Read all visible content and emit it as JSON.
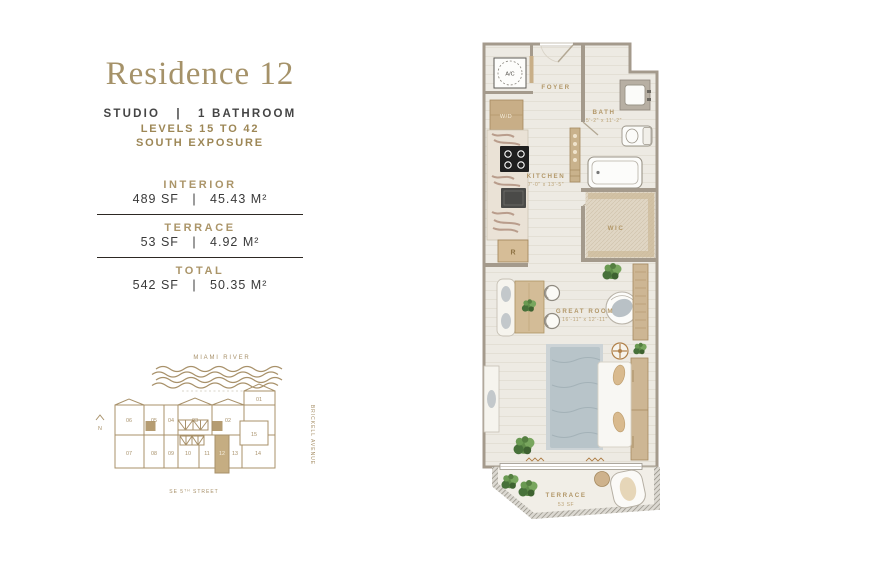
{
  "panel": {
    "title": "Residence 12",
    "subtitle": "STUDIO   |   1 BATHROOM",
    "levels": "LEVELS 15 TO 42",
    "exposure": "SOUTH EXPOSURE",
    "areas": [
      {
        "label": "INTERIOR",
        "value": "489 SF   |   45.43 M²"
      },
      {
        "label": "TERRACE",
        "value": "53 SF   |   4.92 M²"
      },
      {
        "label": "TOTAL",
        "value": "542 SF   |   50.35 M²"
      }
    ]
  },
  "keyplan": {
    "river": "MIAMI RIVER",
    "street_prefix": "SE 5",
    "street_sup": "TH",
    "street_suffix": " STREET",
    "avenue": "BRICKELL AVENUE",
    "north": "N",
    "units_top": [
      "06",
      "05",
      "04",
      "03",
      "02",
      "01"
    ],
    "units_bottom": [
      "07",
      "08",
      "09",
      "10",
      "11",
      "12",
      "13",
      "14"
    ],
    "unit_side": "15",
    "highlighted_unit": "12"
  },
  "floorplan": {
    "ac": "A/C",
    "wd": "W/D",
    "fridge": "R",
    "foyer": "FOYER",
    "bath_label": "BATH",
    "bath_dims": "5'-2\" x 11'-2\"",
    "kitchen_label": "KITCHEN",
    "kitchen_dims": "7'-0\" x 13'-5\"",
    "wic": "WIC",
    "great_room_label": "GREAT ROOM",
    "great_room_dims": "16'-11\" x 12'-11\"",
    "terrace_label": "TERRACE",
    "terrace_area": "53 SF"
  },
  "colors": {
    "gold": "#a59269",
    "gold_dark": "#9d8756",
    "text_dark": "#3a3a3a",
    "keyplan_gold": "#a8916a",
    "highlight_tan": "#c5ad82",
    "wall_gray": "#a49a8c",
    "wood_tan": "#c9b28e",
    "floor": "#edeae3",
    "rug_blue": "#b8c4c9",
    "plant_green": "#5f8c49"
  }
}
